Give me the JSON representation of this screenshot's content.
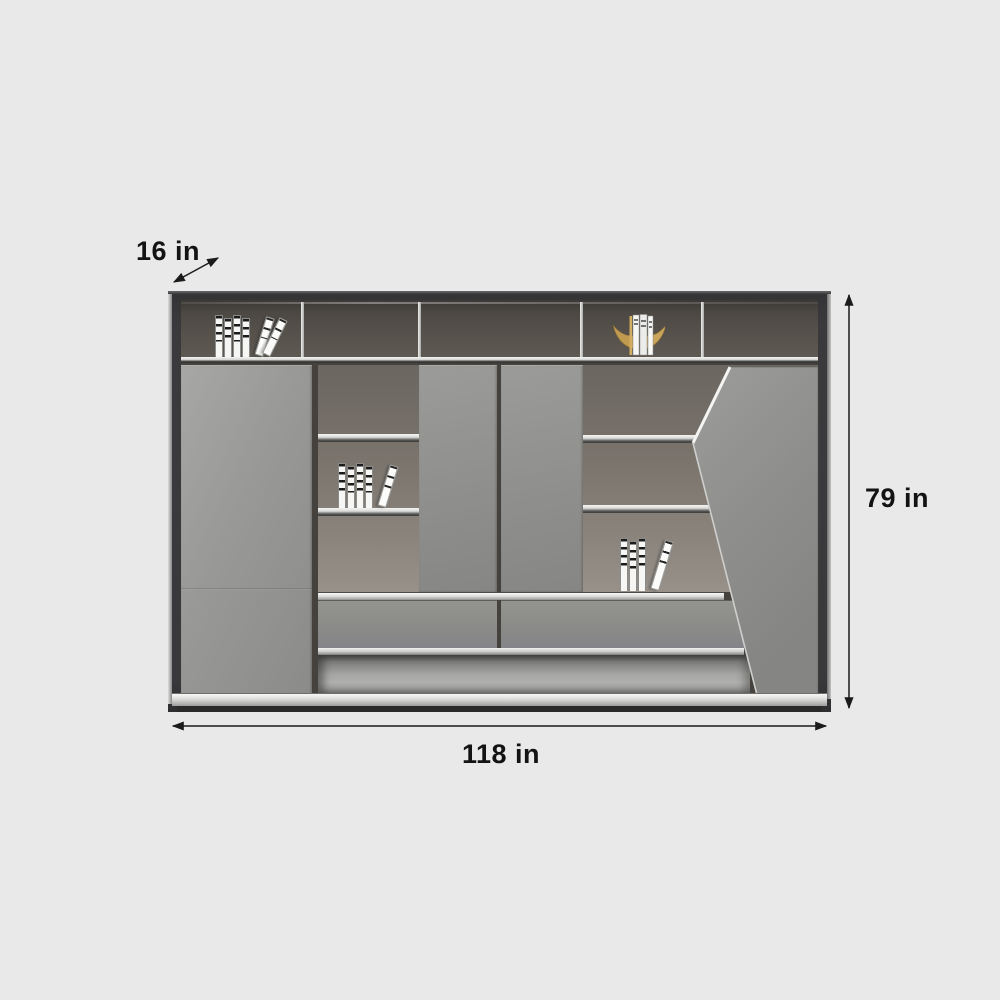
{
  "meta": {
    "description": "Product dimension diagram of a modern gray office wall cabinet bookcase with open shelves, doors, drawers and a slanted accent panel"
  },
  "theme": {
    "background": "#e9e9e9",
    "frame_dark": "#3a3a3c",
    "frame_bevel": "#d6d6d4",
    "top_interior": "#55504a",
    "shelf_interior": "#7b756e",
    "door_gray": "#8f8f8d",
    "door_gray_light": "#a2a2a0",
    "shelf_edge": "#eeeeec",
    "drawer_gray": "#8b8b89",
    "floor_recess": "#a9a9a7",
    "plinth_silver": "#f4f4f2",
    "base_dark": "#2a2a2a",
    "book_white": "#f6f6f4",
    "book_stripe": "#1c1c1c",
    "gold_accent": "#bf9a50",
    "annotation_text": "#131313",
    "arrow_color": "#1b1b1b"
  },
  "annotations": {
    "depth": {
      "label": "16 in"
    },
    "height": {
      "label": "79 in"
    },
    "width": {
      "label": "118 in"
    }
  },
  "decor_items": [
    {
      "name": "white-books-top-left-compartment"
    },
    {
      "name": "gold-bookend-with-books-top-shelf"
    },
    {
      "name": "white-books-middle-left-shelf"
    },
    {
      "name": "white-books-bottom-right-counter"
    }
  ]
}
